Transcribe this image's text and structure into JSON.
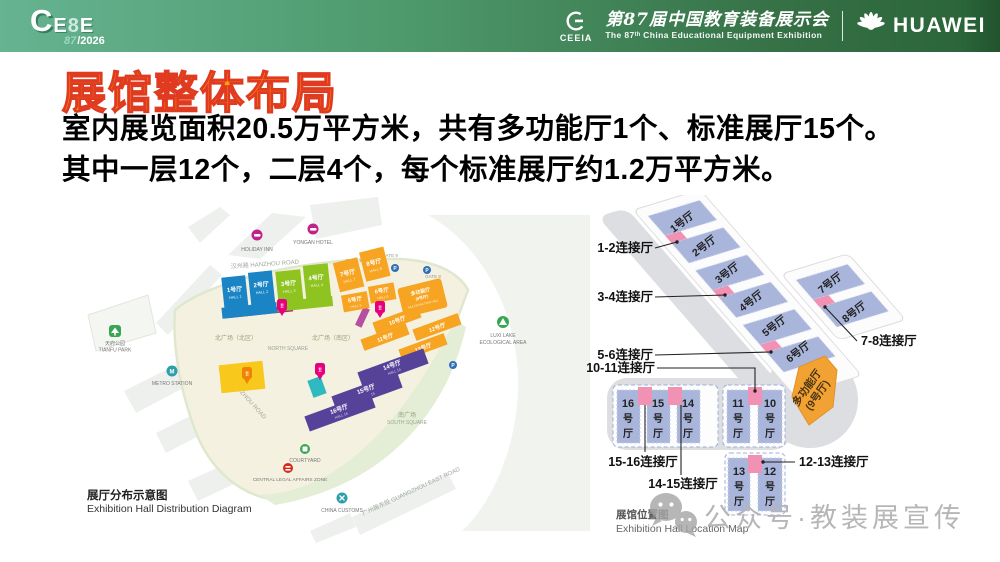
{
  "colors": {
    "header_gradient_left": "#66b391",
    "header_gradient_right": "#2b663a",
    "title_fill": "#f9a40e",
    "title_stroke": "#e03b20",
    "hall_blue": "#1b84c5",
    "hall_green": "#8ec320",
    "hall_orange": "#f7a422",
    "hall_purple": "#564399",
    "periwinkle": "#a9b5db",
    "connector_pink": "#f192b4",
    "multifunction_orange": "#f2a233",
    "bridge_magenta": "#ae1f87",
    "accent_teal": "#2cb9bd",
    "accent_yellow": "#f8c81c"
  },
  "header": {
    "logo_c": "C",
    "logo_e1": "E",
    "logo_8": "8",
    "logo_e2": "E",
    "logo_edition": "87",
    "logo_year": "/2026",
    "ceeia_label": "CEEIA",
    "event_title_cn": "第87届中国教育装备展示会",
    "event_title_en": "The 87ᵗʰ China Educational Equipment Exhibition",
    "huawei_wordmark": "HUAWEI"
  },
  "title": "展馆整体布局",
  "body": {
    "line1": "室内展览面积20.5万平方米，共有多功能厅1个、标准展厅15个。",
    "line2": "其中一层12个，二层4个，每个标准展厅约1.2万平方米。"
  },
  "left_map": {
    "caption_cn": "展厅分布示意图",
    "caption_en": "Exhibition Hall Distribution Diagram",
    "halls": [
      {
        "cn": "1号厅",
        "en": "HALL 1"
      },
      {
        "cn": "2号厅",
        "en": "HALL 2"
      },
      {
        "cn": "3号厅",
        "en": "HALL 3"
      },
      {
        "cn": "4号厅",
        "en": "HALL 4"
      },
      {
        "cn": "5号厅",
        "en": "HALL 5"
      },
      {
        "cn": "6号厅",
        "en": "HALL 6"
      },
      {
        "cn": "7号厅",
        "en": "HALL 7"
      },
      {
        "cn": "8号厅",
        "en": "HALL 8"
      },
      {
        "cn": "多功能厅",
        "cn2": "(9号厅)",
        "en": "MULTIFUNCTION HALL"
      },
      {
        "cn": "10号厅",
        "en": "HALL 10"
      },
      {
        "cn": "11号厅",
        "en": "HALL 11"
      },
      {
        "cn": "12号厅",
        "en": "HALL 12"
      },
      {
        "cn": "13号厅",
        "en": "HALL 13"
      },
      {
        "cn": "14号厅",
        "en": "HALL 14"
      },
      {
        "cn": "15号厅",
        "en": "HALL 15"
      },
      {
        "cn": "16号厅",
        "en": "HALL 16"
      }
    ],
    "squares": {
      "north_n": "北广场（北区）",
      "north_s": "北广场（南区）",
      "north_en": "NORTH SQUARE",
      "south": "南广场",
      "south_en": "SOUTH SQUARE"
    },
    "roads": [
      "汉州路 HANZHOU ROAD",
      "蜀州路 SHUZHOU ROAD",
      "广州路东段 GUANGZHOU EAST ROAD"
    ],
    "gates": [
      "GATE 9",
      "GATE 10",
      "GATE 8"
    ],
    "parking_glyph": "P",
    "pin_glyph": "‼",
    "landmarks": [
      {
        "en": "HOLIDAY INN"
      },
      {
        "en": "YONGAN HOTEL"
      },
      {
        "cn": "天府公园",
        "en": "TIANFU PARK"
      },
      {
        "en": "METRO STATION"
      },
      {
        "en": "LUXI LAKE",
        "en2": "ECOLOGICAL AREA"
      },
      {
        "en": "COURTYARD"
      },
      {
        "en": "CENTRAL LEGAL AFFAIRS ZONE"
      },
      {
        "en": "CHINA CUSTOMS"
      }
    ]
  },
  "right_diagram": {
    "caption_cn": "展馆位置图",
    "caption_en": "Exhibition Hall Location Map",
    "halls": [
      "1号厅",
      "2号厅",
      "3号厅",
      "4号厅",
      "5号厅",
      "6号厅",
      "7号厅",
      "8号厅"
    ],
    "stacked": [
      {
        "num": "16"
      },
      {
        "num": "15"
      },
      {
        "num": "14"
      },
      {
        "num": "11"
      },
      {
        "num": "10"
      },
      {
        "num": "13"
      },
      {
        "num": "12"
      }
    ],
    "suffix1": "号",
    "suffix2": "厅",
    "multi_l1": "多功能厅",
    "multi_l2": "(9号厅)",
    "connectors": [
      "1-2连接厅",
      "3-4连接厅",
      "5-6连接厅",
      "10-11连接厅",
      "15-16连接厅",
      "14-15连接厅",
      "12-13连接厅",
      "7-8连接厅"
    ]
  },
  "watermark": "公众号·教装展宣传"
}
